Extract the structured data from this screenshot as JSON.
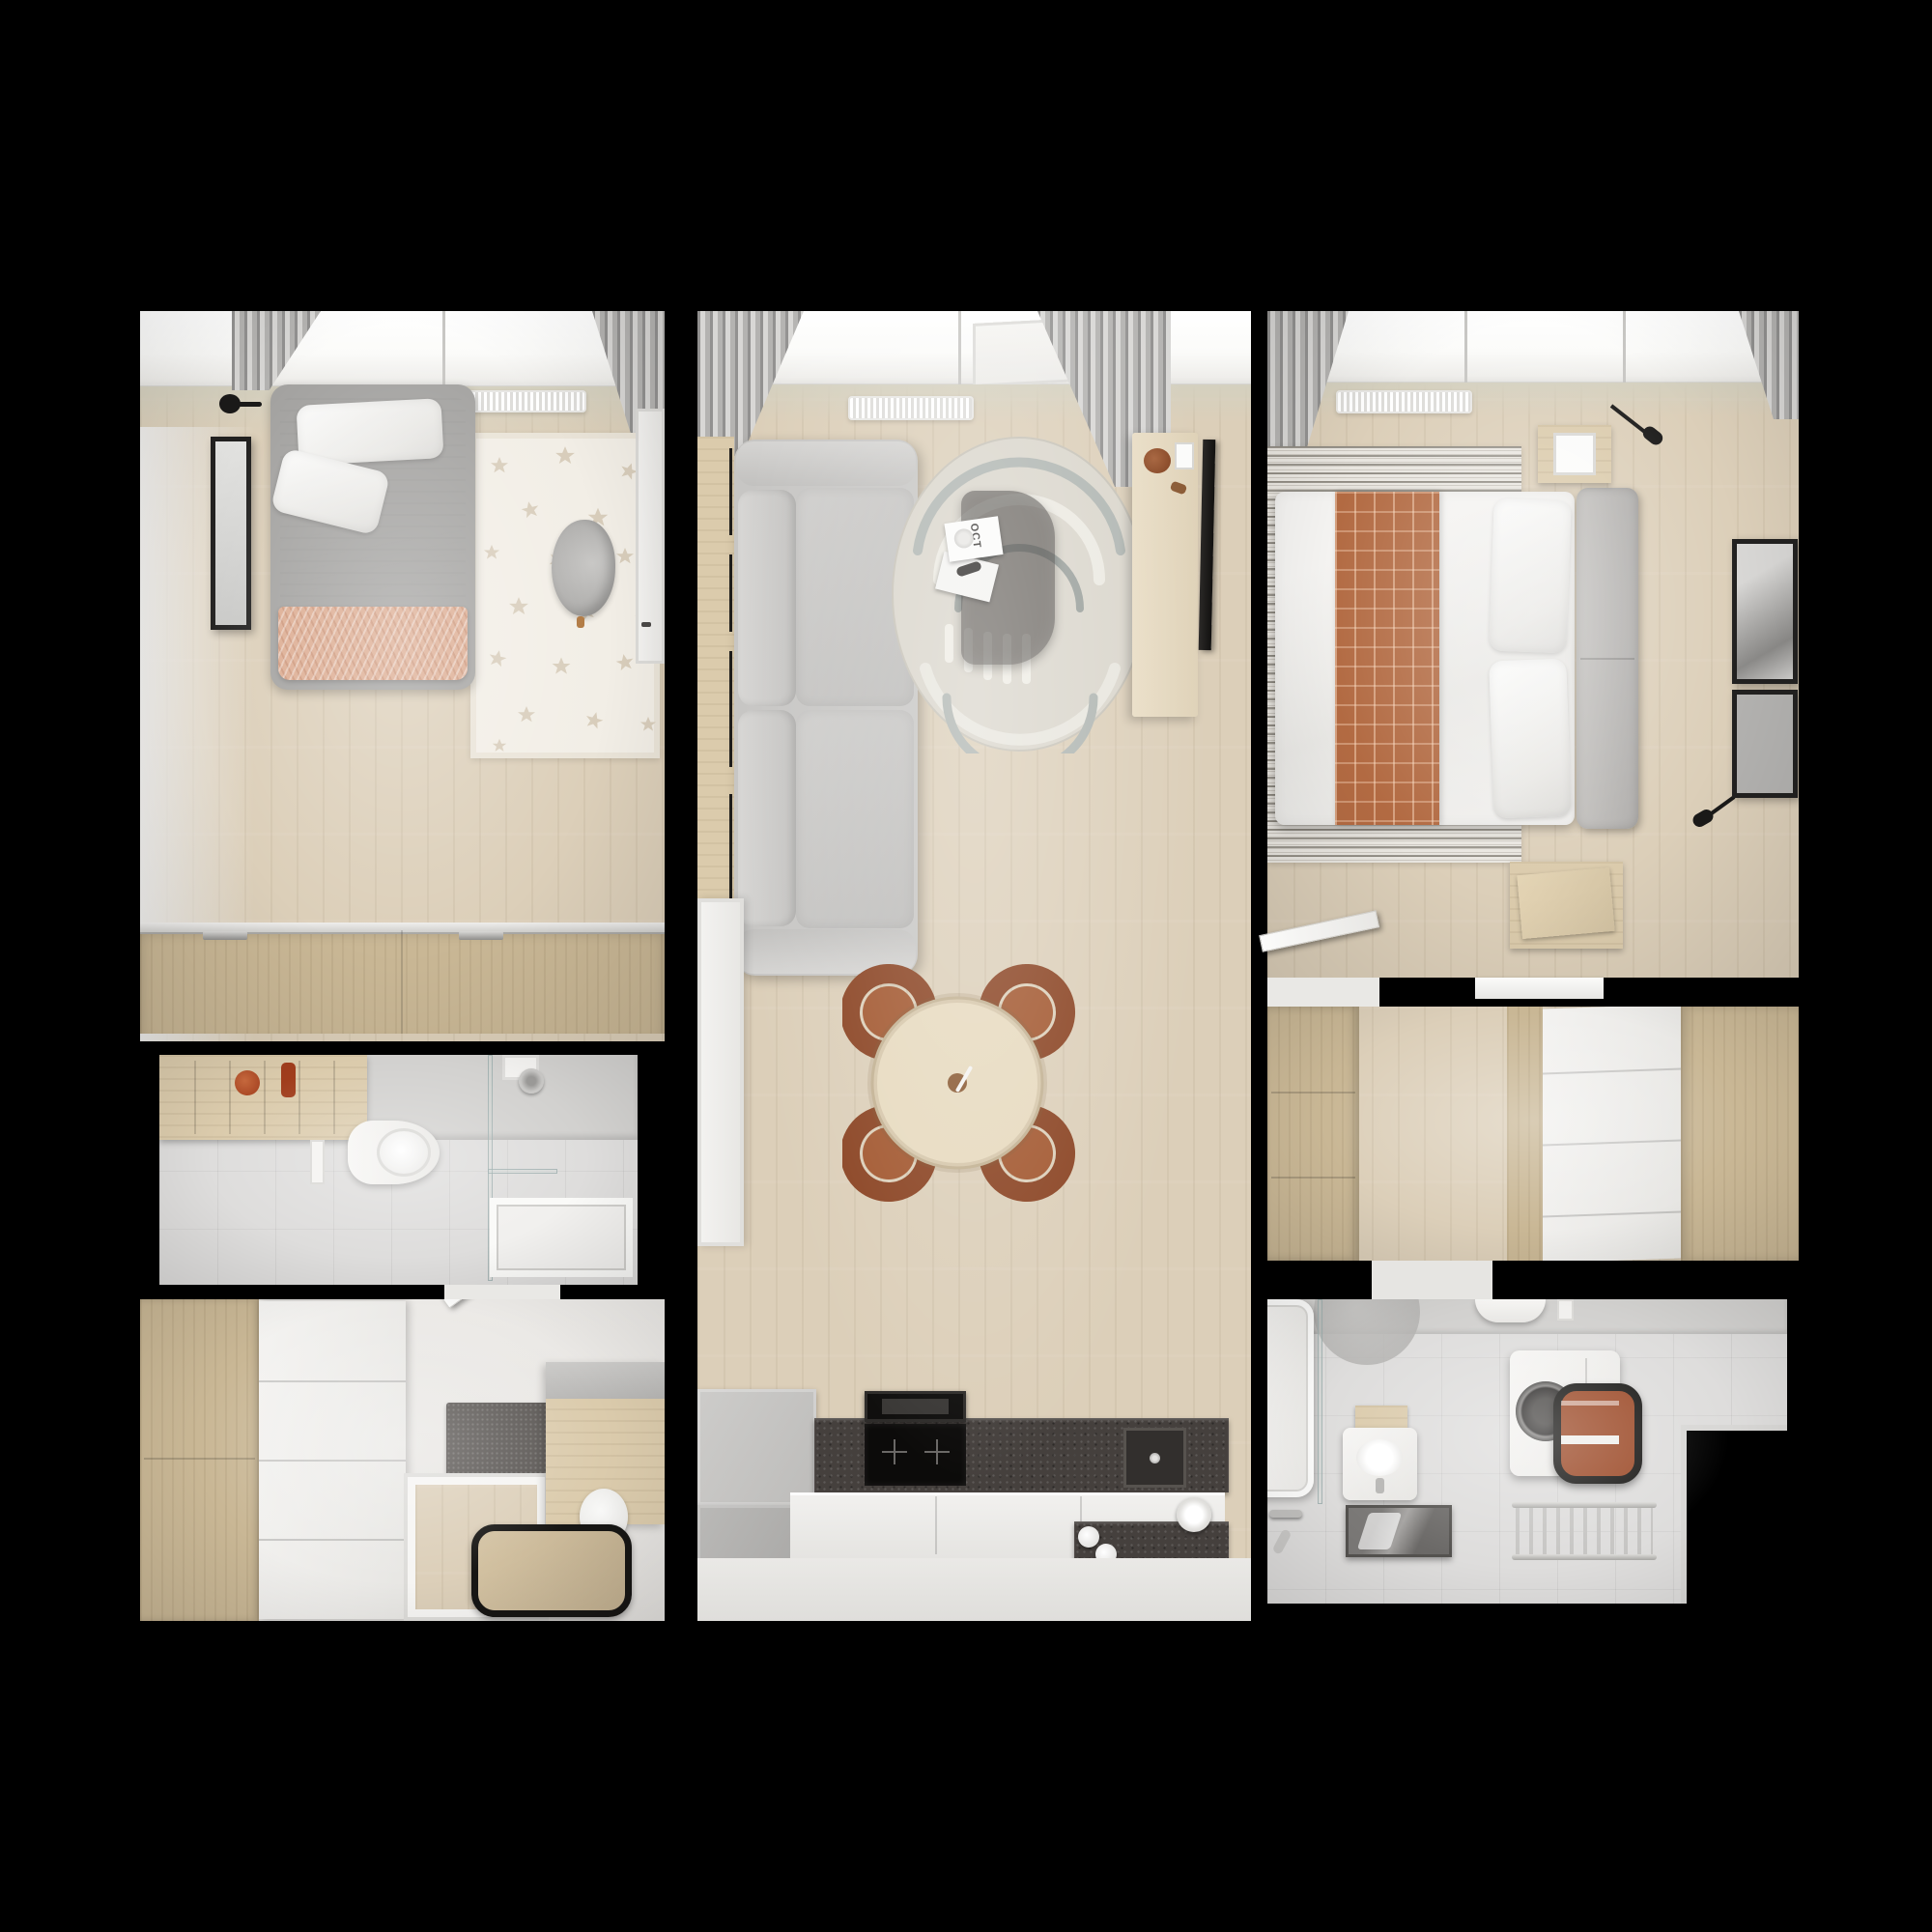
{
  "scene": {
    "type": "apartment-floor-plan",
    "view": "top-down-3d-render",
    "background": "black",
    "visible_text": [
      "OCT"
    ]
  },
  "living_room": {
    "magazine_label": "OCT"
  },
  "palette": {
    "canvas_bg": "#000000",
    "window_glass": "#fbfbf9",
    "wall_tint": "#d4d0bf",
    "floor_wood": "#dccfb9",
    "floor_white": "#ebe9e6",
    "tile_floor": "#dedddc",
    "tile_wall": "#d2d1cf",
    "wood_light": "#dbcbac",
    "wood_mid": "#c9b795",
    "white_furn": "#f1f0ee",
    "sofa_gray": "#c7c6c4",
    "duvet": "#f0efed",
    "blanket_peach": "#dcab90",
    "blanket_rust": "#b26a42",
    "chair_rust": "#a2572f",
    "chair_rust_dark": "#8a4322",
    "granite": "#45403d",
    "appliance_black": "#100f0e",
    "curtain_a": "#929190",
    "curtain_b": "#d8d7d5",
    "star_rug_bg": "#f2eee6",
    "star_fill": "#d8cdbb",
    "rug_base": "#dad6cc",
    "rug_arc_sage": "#adb3af",
    "rug_arc_cream": "#eceae2",
    "stripe_rug_bg": "#e9e6e0",
    "mat_dark": "#575350",
    "chrome": "#c0bfbd",
    "frame_black": "#222120",
    "laundry_rust": "#9c4a28",
    "glass_edge": "rgba(150,168,168,0.75)"
  },
  "rooms": [
    {
      "id": "kids-bedroom",
      "furniture": [
        "single-bed",
        "pillows",
        "peach-blanket",
        "star-rug",
        "armchair",
        "desk-door",
        "wall-mirror",
        "wall-lamp",
        "sliding-wardrobe",
        "radiator",
        "window",
        "curtains"
      ]
    },
    {
      "id": "small-bathroom",
      "furniture": [
        "wall-shelf-unit",
        "wall-hung-toilet",
        "flush-plate",
        "walk-in-shower",
        "shower-head",
        "shower-tray"
      ]
    },
    {
      "id": "entry-dressing-room",
      "furniture": [
        "wardrobe-dresser",
        "dark-mat",
        "wood-floor-tray",
        "side-cabinet",
        "leaning-mirror",
        "stools",
        "door"
      ]
    },
    {
      "id": "living-dining-kitchen",
      "furniture": [
        "sofa",
        "round-arc-rug",
        "glass-coffee-table",
        "magazines",
        "tv-sideboard",
        "wall-tv",
        "dining-table",
        "four-terracotta-chairs",
        "kitchen-counters",
        "induction-hob",
        "cooker-hood",
        "granite-worktop",
        "sink",
        "radiator",
        "window",
        "curtains"
      ]
    },
    {
      "id": "master-bedroom",
      "furniture": [
        "double-bed",
        "plaid-blanket",
        "pillows",
        "headboard",
        "striped-rug",
        "nightstands",
        "wall-lamps",
        "art-frames",
        "radiator",
        "window",
        "curtains",
        "door"
      ]
    },
    {
      "id": "hallway",
      "furniture": [
        "wardrobe",
        "drawer-closet",
        "pass-through-ledge"
      ]
    },
    {
      "id": "main-bathroom",
      "furniture": [
        "bathtub",
        "glass-screen",
        "vanity-sink",
        "mirror",
        "toilet",
        "washing-machine",
        "laundry-basket",
        "towel-radiator",
        "wall-circle-decor"
      ]
    }
  ]
}
